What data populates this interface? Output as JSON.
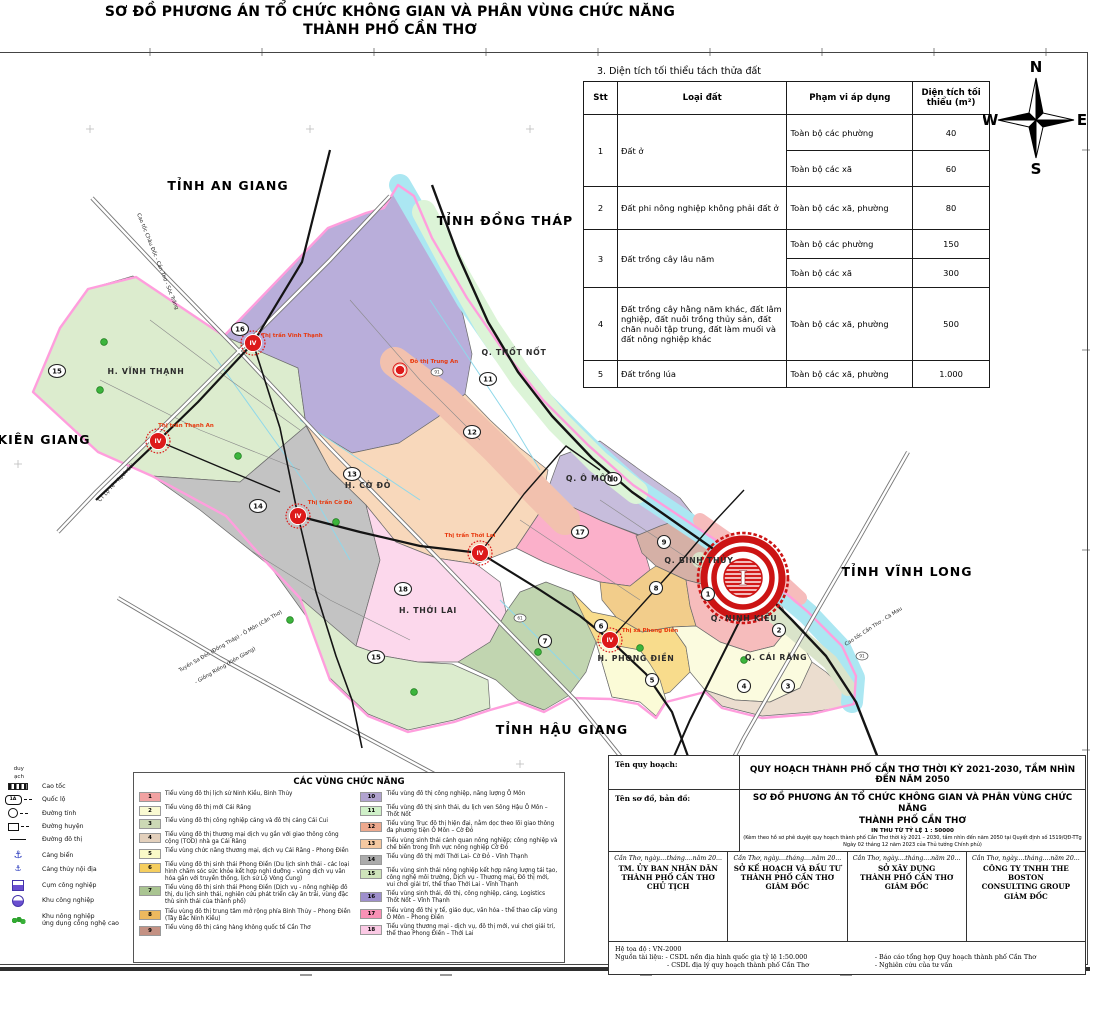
{
  "title": {
    "line1": "SƠ ĐỒ PHƯƠNG ÁN TỔ CHỨC KHÔNG GIAN VÀ PHÂN VÙNG CHỨC NĂNG",
    "line2": "THÀNH PHỐ CẦN THƠ"
  },
  "compass": {
    "n": "N",
    "e": "E",
    "s": "S",
    "w": "W"
  },
  "table": {
    "caption": "3. Diện tích tối thiểu tách thửa đất",
    "headers": [
      "Stt",
      "Loại đất",
      "Phạm vi áp dụng",
      "Diện tích tối thiểu (m²)"
    ],
    "rows": {
      "r1": {
        "stt": "1",
        "land": "Đất ở",
        "subs": [
          {
            "scope": "Toàn bộ các phường",
            "area": "40"
          },
          {
            "scope": "Toàn bộ các xã",
            "area": "60"
          }
        ]
      },
      "r2": {
        "stt": "2",
        "land": "Đất phi nông nghiệp không phải đất ở",
        "scope": "Toàn bộ các xã, phường",
        "area": "80"
      },
      "r3": {
        "stt": "3",
        "land": "Đất trồng cây lâu năm",
        "subs": [
          {
            "scope": "Toàn bộ các phường",
            "area": "150"
          },
          {
            "scope": "Toàn bộ các xã",
            "area": "300"
          }
        ]
      },
      "r4": {
        "stt": "4",
        "land": "Đất trồng cây hằng năm khác, đất lâm nghiệp, đất nuôi trồng thủy sản, đất chăn nuôi tập trung, đất làm muối và đất nông nghiệp khác",
        "scope": "Toàn bộ các xã, phường",
        "area": "500"
      },
      "r5": {
        "stt": "5",
        "land": "Đất trồng lúa",
        "scope": "Toàn bộ các xã, phường",
        "area": "1.000"
      }
    }
  },
  "map": {
    "colors": {
      "boundary": "#FF9EDD",
      "river": "#ABE7F2",
      "road": "#141414",
      "highway_casing": "#777777",
      "canal": "#8FD8EA",
      "town_marker": "#DD1A1A",
      "town_label": "#E8380D"
    },
    "provinces": [
      {
        "name": "TỈNH AN GIANG",
        "x": 228,
        "y": 190
      },
      {
        "name": "TỈNH ĐỒNG THÁP",
        "x": 505,
        "y": 225
      },
      {
        "name": "TỈNH VĨNH LONG",
        "x": 907,
        "y": 576
      },
      {
        "name": "TỈNH HẬU GIANG",
        "x": 562,
        "y": 734
      },
      {
        "name": "KIÊN GIANG",
        "x": 44,
        "y": 444
      }
    ],
    "districts": [
      {
        "name": "H. VĨNH THẠNH",
        "x": 146,
        "y": 374
      },
      {
        "name": "Q. THỐT NỐT",
        "x": 514,
        "y": 355
      },
      {
        "name": "H. CỜ ĐỎ",
        "x": 368,
        "y": 488
      },
      {
        "name": "Q. Ô MÔN",
        "x": 590,
        "y": 481
      },
      {
        "name": "Q. BÌNH THỦY",
        "x": 699,
        "y": 563
      },
      {
        "name": "Q. NINH KIỀU",
        "x": 744,
        "y": 621
      },
      {
        "name": "H. THỚI LAI",
        "x": 428,
        "y": 613
      },
      {
        "name": "H. PHONG ĐIỀN",
        "x": 636,
        "y": 661
      },
      {
        "name": "Q. CÁI RĂNG",
        "x": 776,
        "y": 660
      }
    ],
    "towns": [
      {
        "name": "Thị trấn Thạnh An",
        "badge": "IV",
        "x": 158,
        "y": 441,
        "lx": 186,
        "ly": 427
      },
      {
        "name": "Thị trấn Vĩnh Thạnh",
        "badge": "IV",
        "x": 253,
        "y": 343,
        "lx": 292,
        "ly": 337
      },
      {
        "name": "Thị trấn Cờ Đỏ",
        "badge": "IV",
        "x": 298,
        "y": 516,
        "lx": 330,
        "ly": 504
      },
      {
        "name": "Thị trấn Thới Lai",
        "badge": "IV",
        "x": 480,
        "y": 553,
        "lx": 470,
        "ly": 537
      },
      {
        "name": "Thị xã Phong Điền",
        "badge": "IV",
        "x": 610,
        "y": 640,
        "lx": 650,
        "ly": 632
      }
    ],
    "town_dot": {
      "name": "Đô thị Trung An",
      "x": 400,
      "y": 370,
      "lx": 434,
      "ly": 363
    },
    "road_labels": [
      {
        "name": "Cao tốc Châu Đốc - Cần Thơ - Sóc Trăng",
        "x": 137,
        "y": 214,
        "rot": 68
      },
      {
        "name": "CT Lộ Tẻ - Rạch Sỏi",
        "x": 100,
        "y": 502,
        "rot": -47
      },
      {
        "name": "Tuyến Sa Đéc (Đồng Tháp) - Ô Môn (Cần Thơ)",
        "x": 180,
        "y": 672,
        "rot": -30
      },
      {
        "name": "- Giồng Riềng (Kiên Giang)",
        "x": 196,
        "y": 684,
        "rot": -30
      },
      {
        "name": "Cao tốc Cần Thơ - Cà Mau",
        "x": 846,
        "y": 646,
        "rot": -33
      }
    ],
    "zone_badges": [
      {
        "n": "15",
        "x": 57,
        "y": 371
      },
      {
        "n": "16",
        "x": 240,
        "y": 329
      },
      {
        "n": "11",
        "x": 488,
        "y": 379
      },
      {
        "n": "12",
        "x": 472,
        "y": 432
      },
      {
        "n": "13",
        "x": 352,
        "y": 474
      },
      {
        "n": "14",
        "x": 258,
        "y": 506
      },
      {
        "n": "10",
        "x": 613,
        "y": 479
      },
      {
        "n": "17",
        "x": 580,
        "y": 532
      },
      {
        "n": "9",
        "x": 664,
        "y": 542
      },
      {
        "n": "8",
        "x": 656,
        "y": 588
      },
      {
        "n": "18",
        "x": 403,
        "y": 589
      },
      {
        "n": "7",
        "x": 545,
        "y": 641
      },
      {
        "n": "6",
        "x": 601,
        "y": 626
      },
      {
        "n": "1",
        "x": 708,
        "y": 594
      },
      {
        "n": "2",
        "x": 779,
        "y": 630
      },
      {
        "n": "5",
        "x": 652,
        "y": 680
      },
      {
        "n": "4",
        "x": 744,
        "y": 686
      },
      {
        "n": "3",
        "x": 788,
        "y": 686
      },
      {
        "n": "15",
        "x": 376,
        "y": 657
      }
    ],
    "route_shields": [
      {
        "n": "91",
        "x": 437,
        "y": 372
      },
      {
        "n": "61",
        "x": 520,
        "y": 618
      },
      {
        "n": "91",
        "x": 862,
        "y": 656
      }
    ],
    "center_symbol": {
      "label": "I",
      "x": 743,
      "y": 578
    }
  },
  "legend": {
    "title": "CÁC VÙNG CHỨC NĂNG",
    "items": [
      {
        "num": "1",
        "color": "#F2A2A2",
        "label": "Tiểu vùng đô thị lịch sử Ninh Kiều, Bình Thủy"
      },
      {
        "num": "2",
        "color": "#FAFAD2",
        "label": "Tiểu vùng đô thị mới Cái Răng"
      },
      {
        "num": "3",
        "color": "#CCD9B5",
        "label": "Tiểu vùng đô thị công nghiệp cảng và đô thị cảng Cái Cui"
      },
      {
        "num": "4",
        "color": "#E3D0BC",
        "label": "Tiểu vùng đô thị thương mại dịch vụ gắn với giao thông công cộng (TOD) nhà ga Cái Răng"
      },
      {
        "num": "5",
        "color": "#FAFAC8",
        "label": "Tiểu vùng chức năng thương mại, dịch vụ Cái Răng - Phong Điền"
      },
      {
        "num": "6",
        "color": "#F5CE5F",
        "label": "Tiểu vùng đô thị sinh thái Phong Điền (Du lịch sinh thái - các loại hình chăm sóc sức khỏe kết hợp nghỉ dưỡng - vùng dịch vụ văn hóa gắn với truyền thống, lịch sử Lộ Vòng Cung)"
      },
      {
        "num": "7",
        "color": "#A9C491",
        "label": "Tiểu vùng đô thị sinh thái Phong Điền (Dịch vụ - nông nghiệp đô thị, du lịch sinh thái, nghiên cứu phát triển cây ăn trái, vùng đặc thù sinh thái của thành phố)"
      },
      {
        "num": "8",
        "color": "#EDB95E",
        "label": "Tiểu vùng đô thị trung tâm mở rộng phía Bình Thủy – Phong Điền (Tây Bắc Ninh Kiều)"
      },
      {
        "num": "9",
        "color": "#C49183",
        "label": "Tiểu vùng đô thị cảng hàng không quốc tế Cần Thơ"
      },
      {
        "num": "10",
        "color": "#B1A3CF",
        "label": "Tiểu vùng đô thị công nghiệp, năng lượng Ô Môn"
      },
      {
        "num": "11",
        "color": "#CFF0C8",
        "label": "Tiểu vùng đô thị sinh thái, du lịch ven Sông Hậu Ô Môn – Thốt Nốt"
      },
      {
        "num": "12",
        "color": "#EDA98E",
        "label": "Tiểu vùng Trục đô thị hiện đại, nằm dọc theo lõi giao thông đa phương tiện Ô Môn – Cờ Đỏ"
      },
      {
        "num": "13",
        "color": "#F5C9A1",
        "label": "Tiểu vùng sinh thái cảnh quan nông nghiệp; công nghiệp và chế biến trong lĩnh vực nông nghiệp Cờ Đỏ"
      },
      {
        "num": "14",
        "color": "#ABABAB",
        "label": "Tiểu vùng đô thị mới Thới Lai- Cờ Đỏ - Vĩnh Thạnh"
      },
      {
        "num": "15",
        "color": "#CFE4BB",
        "label": "Tiểu vùng sinh thái nông nghiệp kết hợp năng lượng tái tạo, công nghệ môi trường, Dịch vụ - Thương mại, Đô thị mới, vui chơi giải trí, thể thao Thới Lai - Vĩnh Thạnh"
      },
      {
        "num": "16",
        "color": "#9E8FCC",
        "label": "Tiểu vùng sinh thái, đô thị, công nghiệp, cảng, Logistics Thốt Nốt – Vĩnh Thạnh"
      },
      {
        "num": "17",
        "color": "#F991B5",
        "label": "Tiểu vùng đô thị y tế, giáo dục, văn hóa - thể thao cấp vùng Ô Môn – Phong Điền"
      },
      {
        "num": "18",
        "color": "#FBC9E4",
        "label": "Tiểu vùng thương mại - dịch vụ, đô thị mới, vui chơi giải trí, thể thao Phong Điền – Thới Lai"
      }
    ]
  },
  "symbols": {
    "truncated_fragments": [
      "duy",
      "ạch"
    ],
    "items": [
      {
        "icon": "expressway",
        "label": "Cao tốc"
      },
      {
        "icon": "national-road",
        "badge": "1A",
        "label": "Quốc lộ"
      },
      {
        "icon": "provincial-road",
        "label": "Đường tỉnh"
      },
      {
        "icon": "district-road",
        "label": "Đường huyện"
      },
      {
        "icon": "urban-road",
        "label": "Đường đô thị"
      },
      {
        "icon": "seaport",
        "label": "Cảng biển"
      },
      {
        "icon": "inland-port",
        "label": "Cảng thủy nội địa"
      },
      {
        "icon": "industrial-cluster",
        "label": "Cụm công nghiệp"
      },
      {
        "icon": "industrial-zone",
        "label": "Khu công nghiệp"
      },
      {
        "icon": "hitech-agriculture",
        "label": "Khu nông nghiệp\nứng dụng công nghệ cao"
      }
    ]
  },
  "title_block": {
    "row1_label": "Tên quy hoạch:",
    "row1_value": "QUY HOẠCH THÀNH PHỐ CẦN THƠ THỜI KỲ 2021-2030, TẦM NHÌN ĐẾN NĂM 2050",
    "row2_label": "Tên sơ đồ, bản đồ:",
    "row2_value_line1": "SƠ ĐỒ PHƯƠNG ÁN TỔ CHỨC KHÔNG GIAN VÀ PHÂN VÙNG CHỨC NĂNG",
    "row2_value_line2": "THÀNH PHỐ CẦN THƠ",
    "row2_scale": "IN THU TỪ TỶ LỆ 1 : 50000",
    "row2_note_line1": "(Kèm theo hồ sơ phê duyệt quy hoạch thành phố Cần Thơ thời kỳ 2021 – 2030, tầm nhìn đến năm 2050 tại Quyết định số 1519/QĐ-TTg",
    "row2_note_line2": "Ngày 02 tháng 12 năm 2023 của Thủ tướng Chính phủ)",
    "signatures": [
      {
        "date": "Cần Thơ, ngày....tháng....năm 20...",
        "org_lines": [
          "TM. ỦY BAN NHÂN DÂN",
          "THÀNH PHỐ CẦN THƠ",
          "CHỦ TỊCH"
        ]
      },
      {
        "date": "Cần Thơ, ngày....tháng....năm 20...",
        "org_lines": [
          "SỞ KẾ HOẠCH VÀ ĐẦU TƯ",
          "THÀNH PHỐ CẦN THƠ",
          "GIÁM ĐỐC"
        ]
      },
      {
        "date": "Cần Thơ, ngày....tháng....năm 20...",
        "org_lines": [
          "SỞ XÂY DỰNG",
          "THÀNH PHỐ CẦN THƠ",
          "GIÁM ĐỐC"
        ]
      },
      {
        "date": "Cần Thơ, ngày....tháng....năm 20...",
        "org_lines": [
          "CÔNG TY TNHH THE BOSTON",
          "CONSULTING GROUP",
          "GIÁM ĐỐC"
        ]
      }
    ],
    "footer": {
      "line1": "Hệ tọa độ : VN-2000",
      "line2": "Nguồn tài liệu: - CSDL nền địa hình quốc gia tỷ lệ 1:50.000",
      "line3": "- CSDL địa lý quy hoạch thành phố Cần Thơ",
      "right1": "- Báo cáo tổng hợp Quy hoạch thành phố Cần Thơ",
      "right2": "- Nghiên cứu của tư vấn"
    }
  }
}
